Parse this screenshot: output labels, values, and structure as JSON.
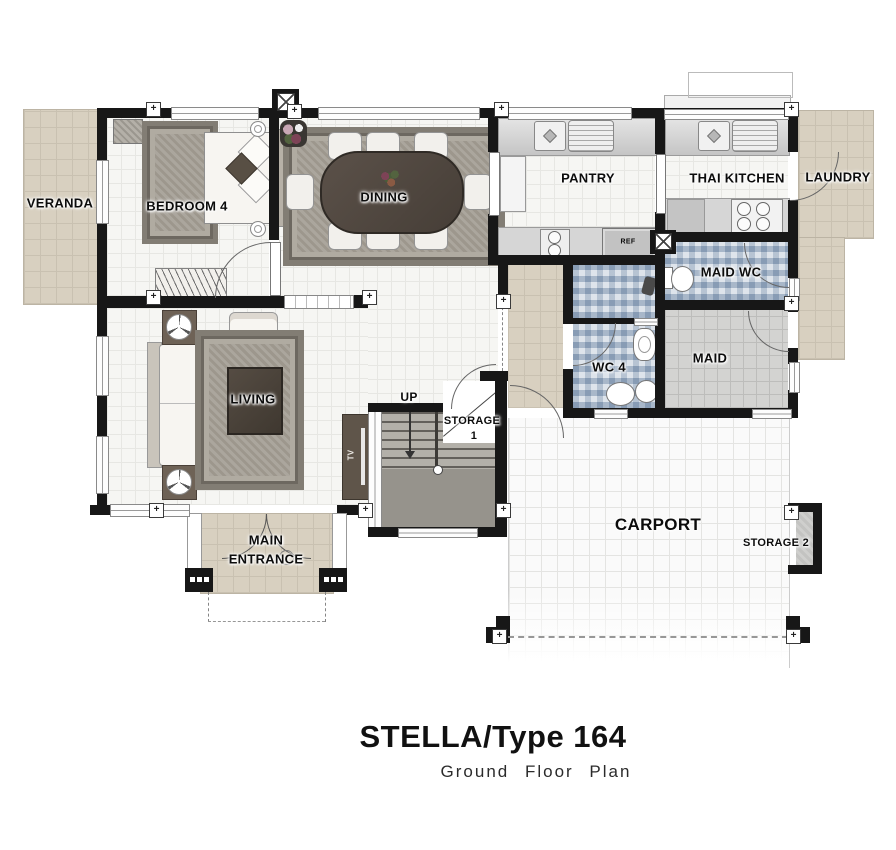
{
  "title": {
    "main": "STELLA/Type 164",
    "subtitle": "Ground Floor Plan"
  },
  "rooms": {
    "veranda": {
      "label": "VERANDA"
    },
    "bedroom4": {
      "label": "BEDROOM 4"
    },
    "dining": {
      "label": "DINING"
    },
    "pantry": {
      "label": "PANTRY"
    },
    "thai_kitchen": {
      "label": "THAI KITCHEN"
    },
    "laundry": {
      "label": "LAUNDRY"
    },
    "maid_wc": {
      "label": "MAID WC"
    },
    "maid": {
      "label": "MAID"
    },
    "wc4": {
      "label": "WC 4"
    },
    "living": {
      "label": "LIVING"
    },
    "storage1": {
      "line1": "STORAGE",
      "line2": "1"
    },
    "storage2": {
      "label": "STORAGE 2"
    },
    "carport": {
      "label": "CARPORT"
    },
    "main_entrance": {
      "line1": "MAIN",
      "line2": "ENTRANCE"
    }
  },
  "annotations": {
    "up": "UP",
    "tv": "TV",
    "ref": "REF"
  },
  "colors": {
    "wall": "#171717",
    "beige_tile": "#d8d0c0",
    "white_tile": "#f6f6f3",
    "mosaic_blue": "#c4cfdc",
    "maid_tile": "#d3d3d1",
    "stair_gray": "#96938c",
    "furniture_dark": "#4c443c",
    "carport_tile": "#fafafa"
  }
}
